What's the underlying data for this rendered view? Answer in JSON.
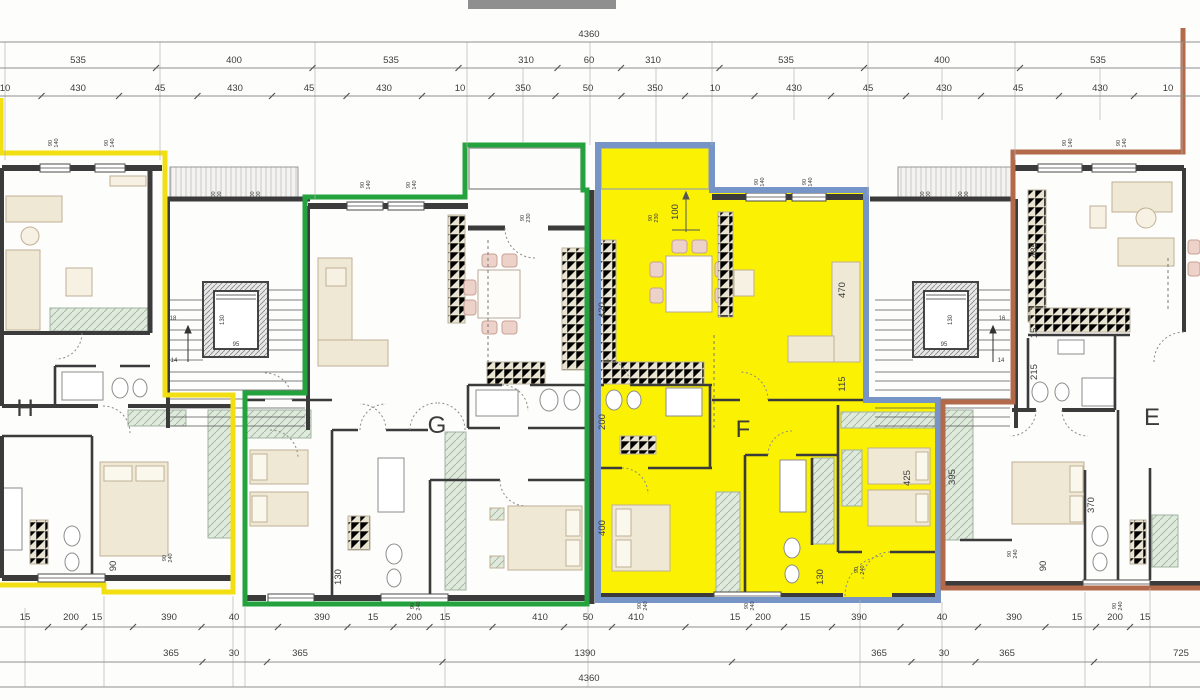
{
  "drawing": {
    "type": "architectural-floor-plan",
    "overall_width_label": "4360",
    "units": [
      "H",
      "G",
      "F",
      "E"
    ],
    "highlighted_unit": "F"
  },
  "colors": {
    "outline_H_yellow": "#F2DF12",
    "outline_G_green": "#23A23D",
    "outline_F_blue": "#7794C7",
    "outline_E_brown": "#B26A4B",
    "fill_F_highlight": "#FBF103",
    "wall": "#3b3b3b",
    "dim_text": "#3c3c3c",
    "furniture": "#efe8d4",
    "wardrobe": "#dfe9dc",
    "counter": "#e9e3d2"
  },
  "dim_rows": [
    {
      "name": "top-overall",
      "y": 37,
      "line_y": 42,
      "labels": [
        {
          "t": "4360",
          "x": 589
        }
      ]
    },
    {
      "name": "top-row2",
      "y": 63,
      "line_y": 68,
      "labels": [
        {
          "t": "535",
          "x": 78
        },
        {
          "t": "400",
          "x": 234
        },
        {
          "t": "535",
          "x": 391
        },
        {
          "t": "310",
          "x": 526
        },
        {
          "t": "60",
          "x": 589
        },
        {
          "t": "310",
          "x": 653
        },
        {
          "t": "535",
          "x": 786
        },
        {
          "t": "400",
          "x": 942
        },
        {
          "t": "535",
          "x": 1098
        }
      ]
    },
    {
      "name": "top-row3",
      "y": 91,
      "line_y": 96,
      "labels": [
        {
          "t": "10",
          "x": 5
        },
        {
          "t": "430",
          "x": 78
        },
        {
          "t": "45",
          "x": 160
        },
        {
          "t": "430",
          "x": 235
        },
        {
          "t": "45",
          "x": 309
        },
        {
          "t": "430",
          "x": 384
        },
        {
          "t": "10",
          "x": 460
        },
        {
          "t": "350",
          "x": 523
        },
        {
          "t": "50",
          "x": 588
        },
        {
          "t": "350",
          "x": 655
        },
        {
          "t": "10",
          "x": 715
        },
        {
          "t": "430",
          "x": 794
        },
        {
          "t": "45",
          "x": 868
        },
        {
          "t": "430",
          "x": 944
        },
        {
          "t": "45",
          "x": 1018
        },
        {
          "t": "430",
          "x": 1100
        },
        {
          "t": "10",
          "x": 1168
        }
      ]
    },
    {
      "name": "bottom-row1",
      "y": 620,
      "line_y": 627,
      "labels": [
        {
          "t": "15",
          "x": 25
        },
        {
          "t": "200",
          "x": 71
        },
        {
          "t": "15",
          "x": 97
        },
        {
          "t": "390",
          "x": 169
        },
        {
          "t": "40",
          "x": 234
        },
        {
          "t": "390",
          "x": 322
        },
        {
          "t": "15",
          "x": 373
        },
        {
          "t": "200",
          "x": 414
        },
        {
          "t": "15",
          "x": 445
        },
        {
          "t": "410",
          "x": 540
        },
        {
          "t": "50",
          "x": 588
        },
        {
          "t": "410",
          "x": 636
        },
        {
          "t": "15",
          "x": 735
        },
        {
          "t": "200",
          "x": 763
        },
        {
          "t": "15",
          "x": 805
        },
        {
          "t": "390",
          "x": 859
        },
        {
          "t": "40",
          "x": 942
        },
        {
          "t": "390",
          "x": 1014
        },
        {
          "t": "15",
          "x": 1077
        },
        {
          "t": "200",
          "x": 1115
        },
        {
          "t": "15",
          "x": 1145
        }
      ]
    },
    {
      "name": "bottom-row2",
      "y": 656,
      "line_y": 662,
      "labels": [
        {
          "t": "365",
          "x": 171
        },
        {
          "t": "30",
          "x": 234
        },
        {
          "t": "365",
          "x": 300
        },
        {
          "t": "1390",
          "x": 585
        },
        {
          "t": "365",
          "x": 879
        },
        {
          "t": "30",
          "x": 944
        },
        {
          "t": "365",
          "x": 1007
        },
        {
          "t": "725",
          "x": 1181
        }
      ]
    },
    {
      "name": "bottom-overall",
      "y": 681,
      "line_y": 687,
      "labels": [
        {
          "t": "4360",
          "x": 589
        }
      ]
    }
  ],
  "interior_dims": [
    {
      "t": "420",
      "x": 605,
      "y": 310,
      "rot": true
    },
    {
      "t": "200",
      "x": 605,
      "y": 422,
      "rot": true
    },
    {
      "t": "400",
      "x": 605,
      "y": 528,
      "rot": true
    },
    {
      "t": "100",
      "x": 678,
      "y": 212,
      "rot": true
    },
    {
      "t": "470",
      "x": 845,
      "y": 290,
      "rot": true
    },
    {
      "t": "115",
      "x": 845,
      "y": 384,
      "rot": true
    },
    {
      "t": "425",
      "x": 910,
      "y": 478,
      "rot": true
    },
    {
      "t": "395",
      "x": 955,
      "y": 477,
      "rot": true
    },
    {
      "t": "370",
      "x": 1094,
      "y": 505,
      "rot": true
    },
    {
      "t": "485",
      "x": 1037,
      "y": 250,
      "rot": true
    },
    {
      "t": "15",
      "x": 1037,
      "y": 333,
      "rot": true
    },
    {
      "t": "215",
      "x": 1037,
      "y": 372,
      "rot": true
    },
    {
      "t": "90",
      "x": 116,
      "y": 566,
      "rot": true
    },
    {
      "t": "90",
      "x": 1046,
      "y": 566,
      "rot": true
    },
    {
      "t": "130",
      "x": 341,
      "y": 577,
      "rot": true
    },
    {
      "t": "130",
      "x": 823,
      "y": 577,
      "rot": true
    }
  ],
  "window_labels": [
    {
      "t": "90",
      "b": "140",
      "x": 52,
      "y": 143
    },
    {
      "t": "90",
      "b": "140",
      "x": 108,
      "y": 143
    },
    {
      "t": "90",
      "b": "140",
      "x": 364,
      "y": 185
    },
    {
      "t": "90",
      "b": "140",
      "x": 410,
      "y": 185
    },
    {
      "t": "90",
      "b": "140",
      "x": 758,
      "y": 182
    },
    {
      "t": "90",
      "b": "140",
      "x": 806,
      "y": 182
    },
    {
      "t": "90",
      "b": "140",
      "x": 1066,
      "y": 143
    },
    {
      "t": "90",
      "b": "140",
      "x": 1120,
      "y": 143
    },
    {
      "t": "100",
      "b": "200",
      "x": 215,
      "y": 196
    },
    {
      "t": "100",
      "b": "200",
      "x": 254,
      "y": 196
    },
    {
      "t": "100",
      "b": "200",
      "x": 924,
      "y": 196
    },
    {
      "t": "100",
      "b": "200",
      "x": 962,
      "y": 196
    },
    {
      "t": "90",
      "b": "230",
      "x": 524,
      "y": 218
    },
    {
      "t": "90",
      "b": "230",
      "x": 652,
      "y": 218
    },
    {
      "t": "90",
      "b": "240",
      "x": 166,
      "y": 558
    },
    {
      "t": "90",
      "b": "240",
      "x": 414,
      "y": 606
    },
    {
      "t": "90",
      "b": "240",
      "x": 641,
      "y": 606
    },
    {
      "t": "90",
      "b": "240",
      "x": 748,
      "y": 606
    },
    {
      "t": "90",
      "b": "240",
      "x": 858,
      "y": 570
    },
    {
      "t": "90",
      "b": "240",
      "x": 1011,
      "y": 554
    },
    {
      "t": "90",
      "b": "240",
      "x": 1116,
      "y": 606
    }
  ],
  "core_labels": [
    {
      "t": "130",
      "x": 224,
      "y": 320,
      "rot": true
    },
    {
      "t": "95",
      "x": 236,
      "y": 346
    },
    {
      "t": "130",
      "x": 952,
      "y": 320,
      "rot": true
    },
    {
      "t": "95",
      "x": 944,
      "y": 346
    },
    {
      "t": "18",
      "x": 173,
      "y": 320
    },
    {
      "t": "14",
      "x": 174,
      "y": 362
    },
    {
      "t": "16",
      "x": 1002,
      "y": 320
    },
    {
      "t": "14",
      "x": 1001,
      "y": 362
    }
  ],
  "unit_labels": [
    {
      "t": "H",
      "x": 25,
      "y": 416
    },
    {
      "t": "G",
      "x": 437,
      "y": 433
    },
    {
      "t": "F",
      "x": 743,
      "y": 437
    },
    {
      "t": "E",
      "x": 1152,
      "y": 425
    }
  ]
}
